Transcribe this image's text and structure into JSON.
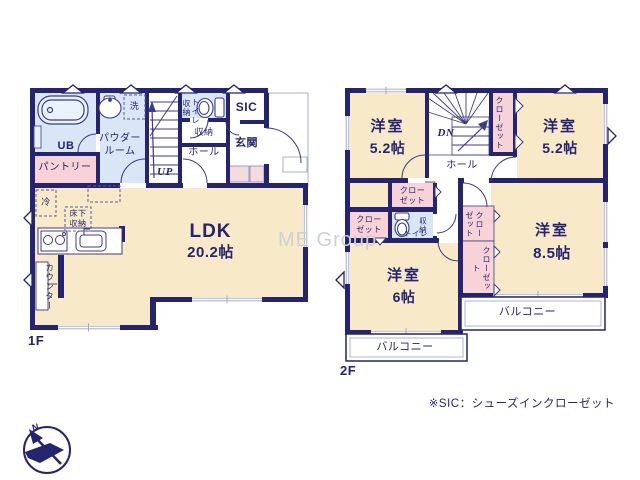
{
  "watermark": "ME Group",
  "footnote": "※SIC：シューズインクローゼット",
  "compass": {
    "north": "N"
  },
  "colors": {
    "wall": "#242470",
    "room": "#f8e9c8",
    "wet_area": "#d9e6f5",
    "closet": "#f7d2d6",
    "text": "#242470",
    "watermark": "#d0d0d0"
  },
  "floor1": {
    "label": "1F",
    "ldk": {
      "name": "LDK",
      "size": "20.2帖"
    },
    "ub": "UB",
    "powder_room": "パウダー\nルーム",
    "laundry": "洗",
    "pantry": "パントリー",
    "fridge": "冷",
    "underfloor_storage": "床下\n収納",
    "counter": "カウンター",
    "stairs_up": "UP",
    "wc_storage": "収納",
    "toilet": "トイレ",
    "hall_storage": "収納",
    "hall": "ホール",
    "sic": "SIC",
    "entrance": "玄関"
  },
  "floor2": {
    "label": "2F",
    "room_nw": {
      "name": "洋室",
      "size": "5.2帖"
    },
    "room_ne": {
      "name": "洋室",
      "size": "5.2帖"
    },
    "room_se": {
      "name": "洋室",
      "size": "8.5帖"
    },
    "room_sw": {
      "name": "洋室",
      "size": "6帖"
    },
    "stairs_down": "DN",
    "hall": "ホール",
    "closet_ne": "クローゼット",
    "closet_n": "クロー\nゼット",
    "closet_w": "クロー\nゼット",
    "wc_storage": "収納",
    "toilet": "トイレ",
    "closet_e_upper": "クロー\nゼット",
    "closet_e_lower": "クローゼット",
    "balcony_sw": "バルコニー",
    "balcony_se": "バルコニー"
  }
}
